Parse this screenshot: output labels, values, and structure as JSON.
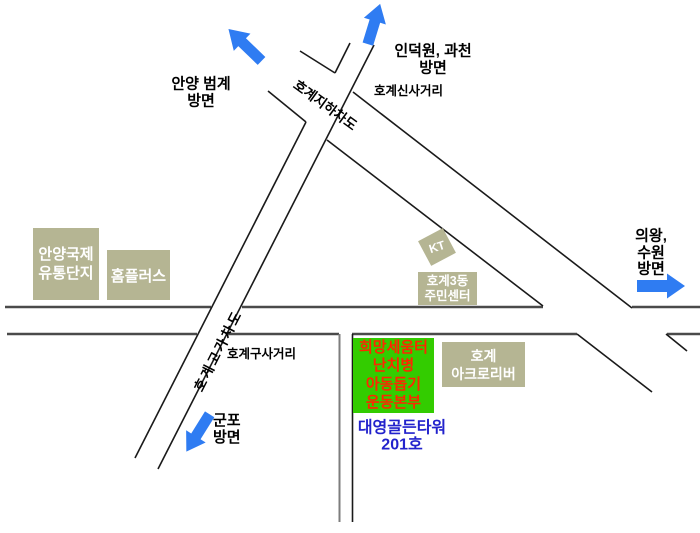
{
  "map_title": "호계동 약도",
  "colors": {
    "road_main": "#4a4a4a",
    "road_thin": "#1a1a1a",
    "road_gray": "#7d7d7d",
    "arrow_blue": "#2f7cf2",
    "building_bg": "#b5b593",
    "building_text": "#ffffff",
    "destination_bg": "#33cc00",
    "destination_text": "#ff2600",
    "address_text": "#2222cc"
  },
  "direction_labels": {
    "anyang_beomgye": "안양 범계\n방면",
    "indeogwon_gwacheon": "인덕원, 과천\n방면",
    "uiwang_suwon": "의왕, 수원\n방면",
    "gunpo": "군포\n방면"
  },
  "road_labels": {
    "hogye_underpass": "호계지하차도",
    "hogye_overpass": "호계고가차도",
    "hogye_sinsa_intersection": "호계신사거리",
    "hogye_gusa_intersection": "호계구사거리"
  },
  "buildings": {
    "anyang_intl_complex": "안양국제\n유통단지",
    "homeplus": "홈플러스",
    "kt": "KT",
    "hogye3dong_center": "호계3동\n주민센터",
    "hogye_acroriver": "호계\n아크로리버"
  },
  "destination": {
    "name": "희망세움터\n난치병\n아동돕기\n운동본부",
    "address": "대영골든타워\n201호"
  },
  "icons": {
    "arrow_up_left": "block-arrow-up-left",
    "arrow_up": "block-arrow-up",
    "arrow_right": "block-arrow-right",
    "arrow_down_left": "block-arrow-down-left"
  }
}
